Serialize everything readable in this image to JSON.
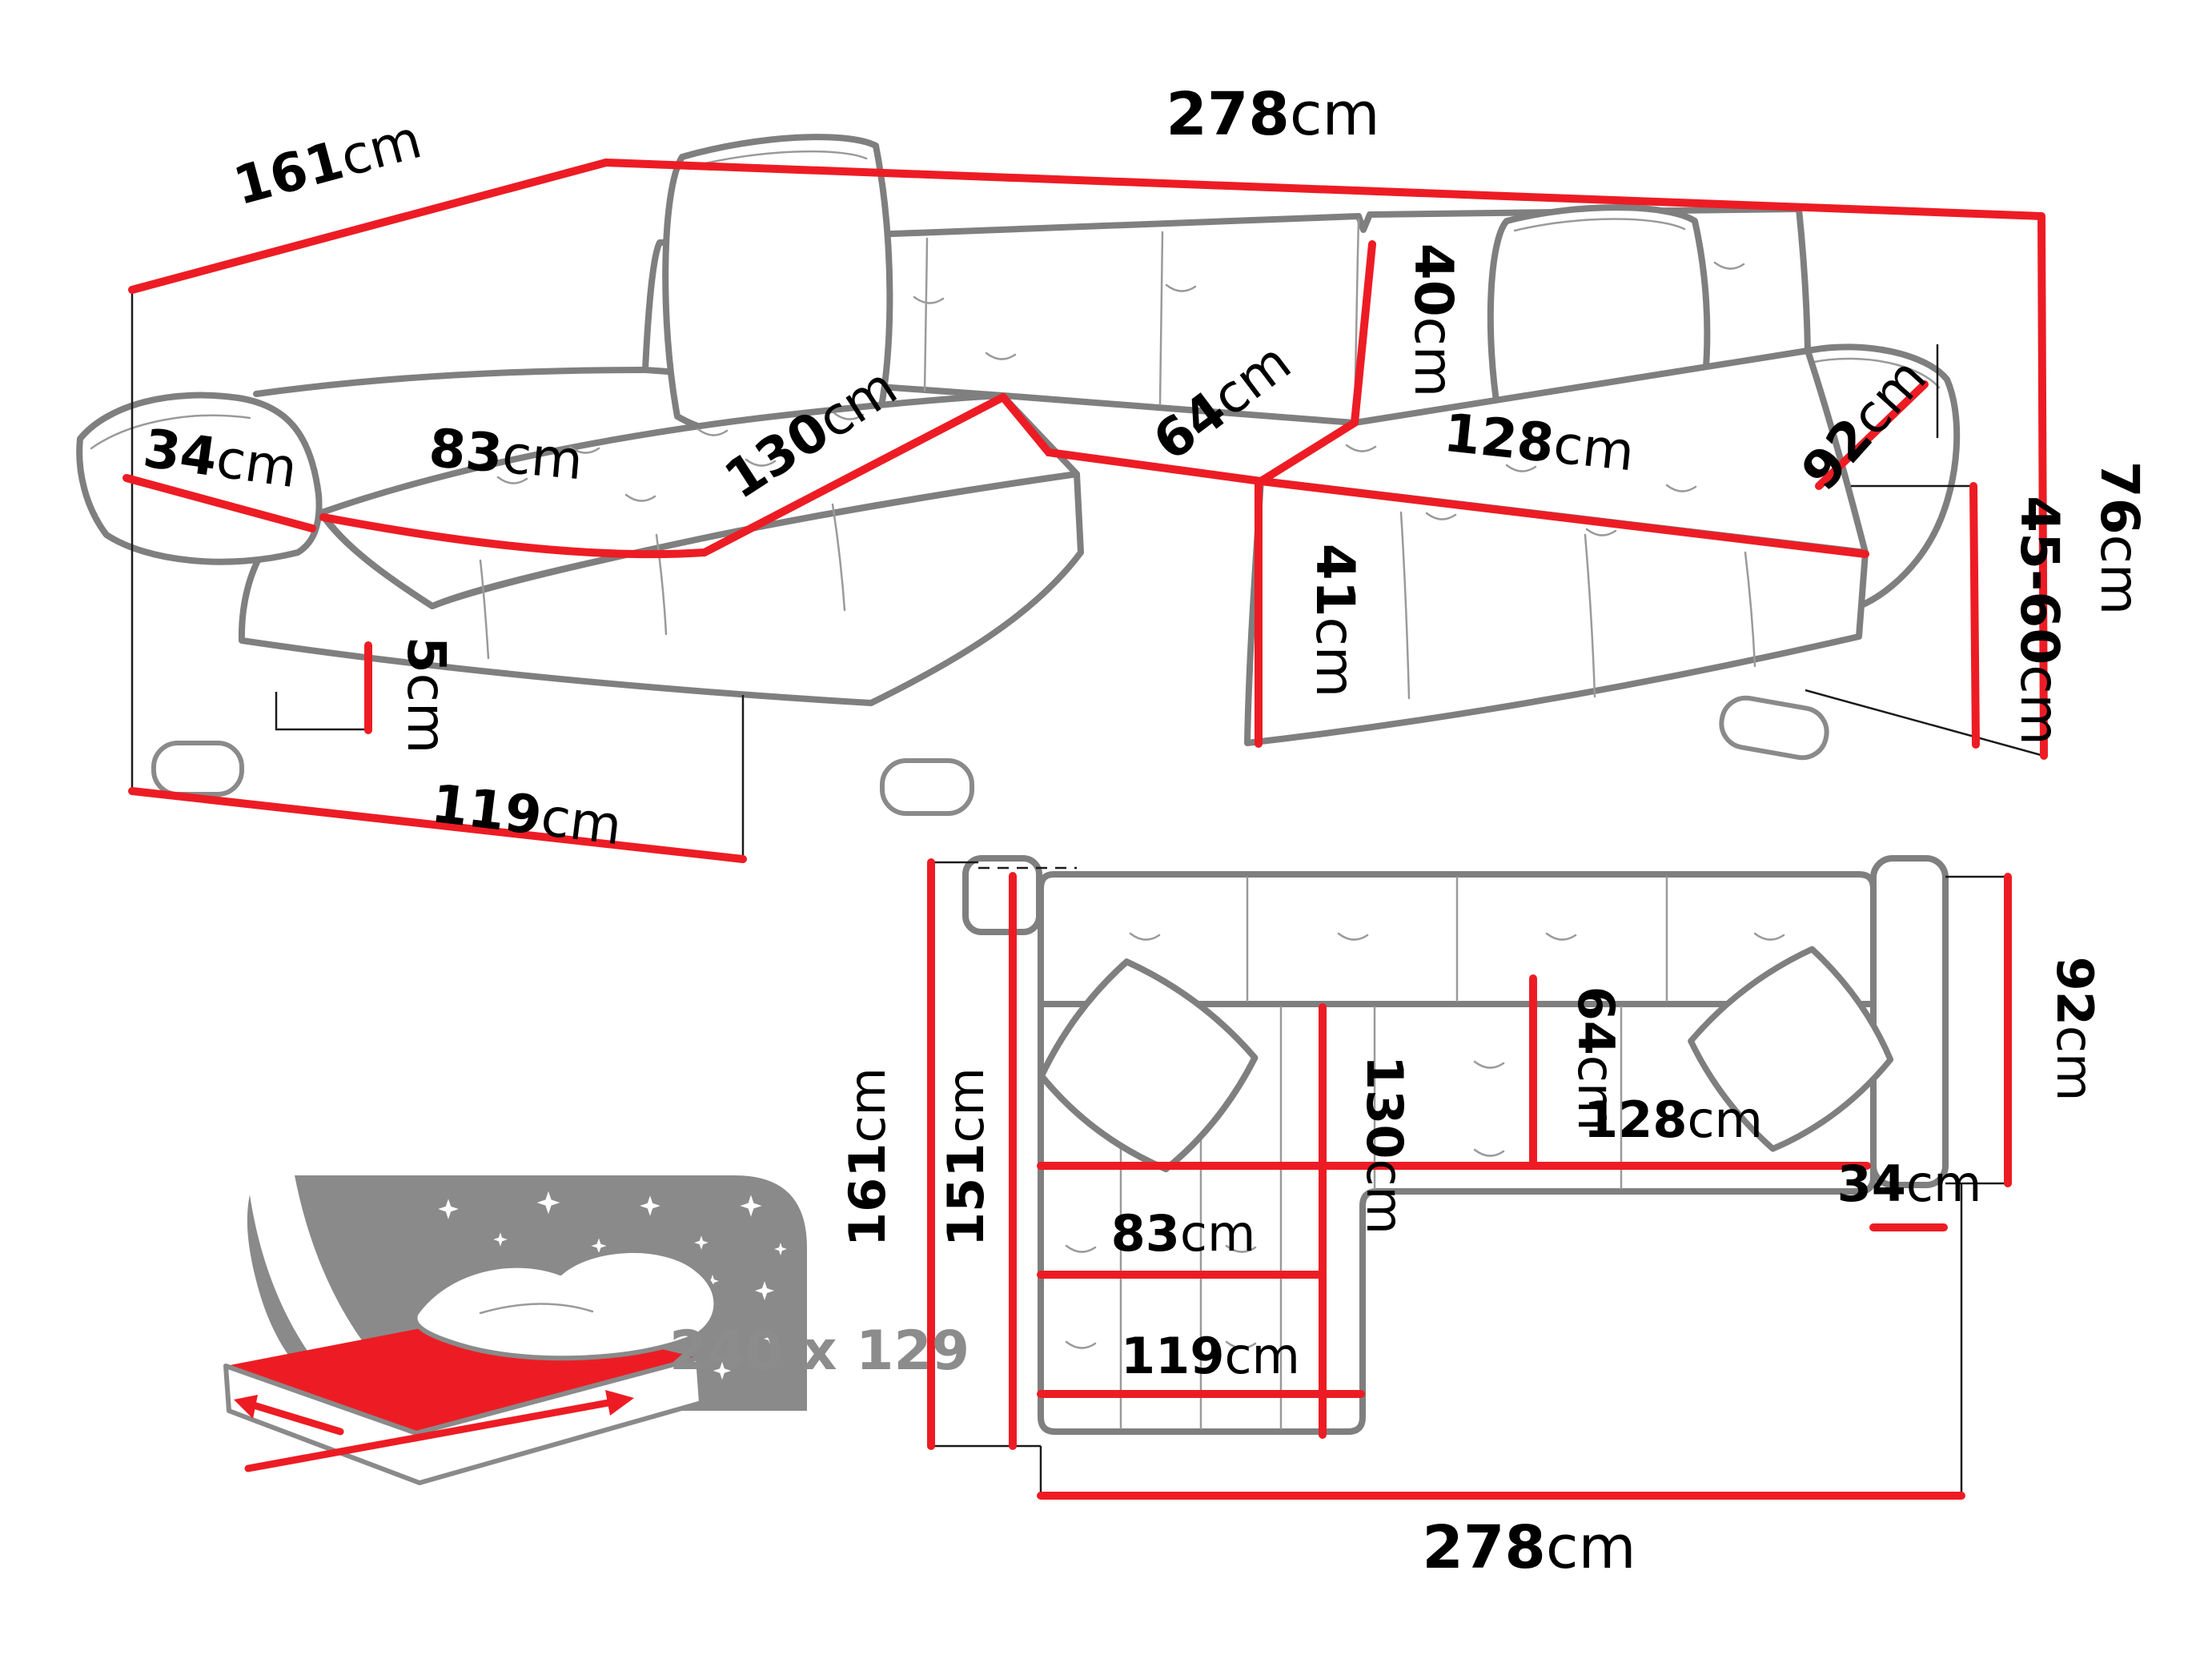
{
  "figure": {
    "type": "furniture dimension diagram",
    "product": "corner sofa bed with chaise",
    "views": [
      "front perspective view",
      "top plan view",
      "sleeping area icon"
    ]
  },
  "colors": {
    "dimension_red": "#ed1c24",
    "outline_gray": "#7f7f7f",
    "detail_gray": "#9a9a9a",
    "icon_gray": "#8a8a8a",
    "label_gray": "#8c8c8c",
    "text_black": "#000000",
    "background": "#ffffff"
  },
  "front_view": {
    "dimensions": {
      "total_width": {
        "value": "278",
        "unit": "cm"
      },
      "total_depth": {
        "value": "161",
        "unit": "cm"
      },
      "armrest_width": {
        "value": "34",
        "unit": "cm"
      },
      "chaise_seat_width": {
        "value": "83",
        "unit": "cm"
      },
      "chaise_seat_depth": {
        "value": "130",
        "unit": "cm"
      },
      "backrest_height": {
        "value": "40",
        "unit": "cm"
      },
      "seat_depth": {
        "value": "64",
        "unit": "cm"
      },
      "seat_width": {
        "value": "128",
        "unit": "cm"
      },
      "armrest_depth": {
        "value": "92",
        "unit": "cm"
      },
      "total_height": {
        "value": "76",
        "unit": "cm"
      },
      "seat_height_range": {
        "value": "45-60",
        "unit": "cm"
      },
      "seat_height": {
        "value": "41",
        "unit": "cm"
      },
      "leg_height": {
        "value": "5",
        "unit": "cm"
      },
      "chaise_length": {
        "value": "119",
        "unit": "cm"
      }
    }
  },
  "top_view": {
    "dimensions": {
      "total_depth": {
        "value": "161",
        "unit": "cm"
      },
      "depth_without_back": {
        "value": "151",
        "unit": "cm"
      },
      "chaise_inner_length": {
        "value": "130",
        "unit": "cm"
      },
      "seat_depth": {
        "value": "64",
        "unit": "cm"
      },
      "seat_width": {
        "value": "128",
        "unit": "cm"
      },
      "armrest_width": {
        "value": "34",
        "unit": "cm"
      },
      "armrest_depth": {
        "value": "92",
        "unit": "cm"
      },
      "chaise_seat_width": {
        "value": "83",
        "unit": "cm"
      },
      "chaise_width": {
        "value": "119",
        "unit": "cm"
      },
      "total_width": {
        "value": "278",
        "unit": "cm"
      }
    }
  },
  "sleeping_area": {
    "label": "240 x 129"
  }
}
